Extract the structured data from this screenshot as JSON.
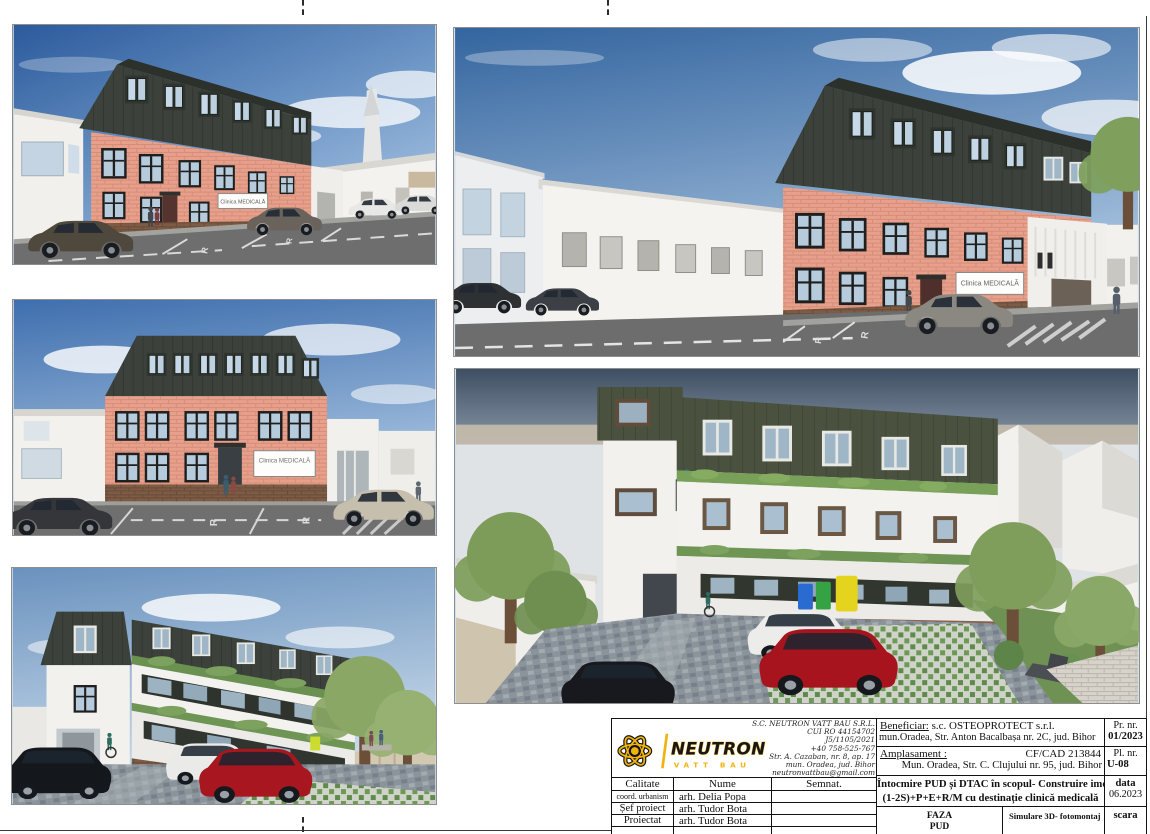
{
  "sheet": {
    "sign_text": "Clinica MEDICALĂ",
    "road_marking": "R"
  },
  "title_block": {
    "company": {
      "name": "S.C. NEUTRON VATT BAU S.R.L.",
      "cui": "CUI RO 44154702",
      "reg_no": "J5/1105/2021",
      "phone": "+40 758-525-767",
      "address_street": "Str. A. Cazaban, nr. 8, ap. 17",
      "address_city": "mun. Oradea, jud. Bihor",
      "email": "neutronvattbau@gmail.com",
      "logo_text": "NEUTRON",
      "logo_subtext": "VATT BAU"
    },
    "beneficiary": {
      "label": "Beneficiar:",
      "name": "s.c. OSTEOPROTECT s.r.l.",
      "address": "mun.Oradea, Str. Anton Bacalbașa nr. 2C, jud. Bihor"
    },
    "project_no": {
      "label": "Pr. nr.",
      "value": "01/2023"
    },
    "site": {
      "label": "Amplasament :",
      "cf_cad": "CF/CAD 213844",
      "address": "Mun. Oradea, Str. C. Clujului nr. 95, jud. Bihor"
    },
    "plan_no": {
      "label": "Pl. nr.",
      "value": "U-08"
    },
    "signatures": {
      "headers": {
        "calitate": "Calitate",
        "nume": "Nume",
        "semnat": "Semnat."
      },
      "rows": [
        {
          "calitate": "coord. urbanism",
          "nume": "arh. Delia Popa"
        },
        {
          "calitate": "Șef proiect",
          "nume": "arh. Tudor Bota"
        },
        {
          "calitate": "Proiectat",
          "nume": "arh. Tudor Bota"
        }
      ]
    },
    "project_title": {
      "line1": "Întocmire PUD și DTAC în scopul- Construire imobil",
      "line2": "(1-2S)+P+E+R/M cu destinație clinică medicală"
    },
    "date": {
      "label": "data",
      "value": "06.2023"
    },
    "phase": {
      "label": "FAZA",
      "value": "PUD"
    },
    "drawing_title": "Simulare 3D- fotomontaj",
    "scale_label": "scara",
    "colors": {
      "accent_yellow": "#f0b411",
      "line_black": "#111111"
    }
  }
}
